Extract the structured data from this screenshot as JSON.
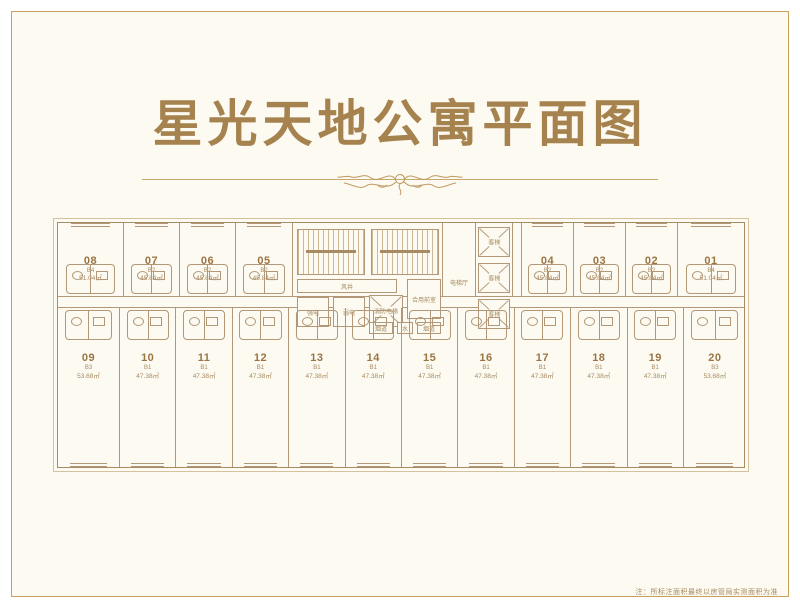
{
  "title": "星光天地公寓平面图",
  "footnote": "注：所标注面积最终以房管局实测面积为准",
  "colors": {
    "frame_gold": "#C9A05C",
    "background_cream": "#FCFAF1",
    "title_gold": "#A5824E",
    "plan_line": "#B29878",
    "unit_number": "#9A7444"
  },
  "floor_plan": {
    "top_left_units": [
      {
        "number": "08",
        "type": "B4",
        "area": "51.04㎡"
      },
      {
        "number": "07",
        "type": "B2",
        "area": "45.84㎡"
      },
      {
        "number": "06",
        "type": "B2",
        "area": "45.84㎡"
      },
      {
        "number": "05",
        "type": "B2",
        "area": "45.84㎡"
      }
    ],
    "top_right_units": [
      {
        "number": "04",
        "type": "B2",
        "area": "45.84㎡"
      },
      {
        "number": "03",
        "type": "B2",
        "area": "45.84㎡"
      },
      {
        "number": "02",
        "type": "B2",
        "area": "45.84㎡"
      },
      {
        "number": "01",
        "type": "B4",
        "area": "51.04㎡"
      }
    ],
    "bottom_units": [
      {
        "number": "09",
        "type": "B3",
        "area": "53.68㎡"
      },
      {
        "number": "10",
        "type": "B1",
        "area": "47.38㎡"
      },
      {
        "number": "11",
        "type": "B1",
        "area": "47.38㎡"
      },
      {
        "number": "12",
        "type": "B1",
        "area": "47.38㎡"
      },
      {
        "number": "13",
        "type": "B1",
        "area": "47.38㎡"
      },
      {
        "number": "14",
        "type": "B1",
        "area": "47.38㎡"
      },
      {
        "number": "15",
        "type": "B1",
        "area": "47.38㎡"
      },
      {
        "number": "16",
        "type": "B1",
        "area": "47.38㎡"
      },
      {
        "number": "17",
        "type": "B1",
        "area": "47.38㎡"
      },
      {
        "number": "18",
        "type": "B1",
        "area": "47.38㎡"
      },
      {
        "number": "19",
        "type": "B1",
        "area": "47.38㎡"
      },
      {
        "number": "20",
        "type": "B3",
        "area": "53.68㎡"
      }
    ],
    "core": {
      "wind_shaft": "风井",
      "strong_electric": "强电",
      "weak_electric": "弱电",
      "fire_elevator": "消防电梯",
      "shared_front_room": "合用前室",
      "flue": "烟道",
      "water": "水",
      "elevator_hall": "电梯厅",
      "passenger_elevator": "客梯"
    }
  }
}
